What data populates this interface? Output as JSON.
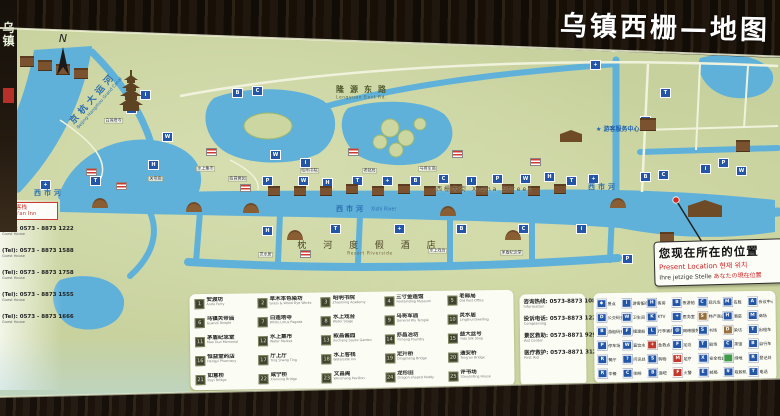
{
  "title": "乌镇西栅—地图",
  "compass": "N",
  "left_sign": "乌镇",
  "map": {
    "canal": {
      "zh": "京杭大运河",
      "en": "Beijing-Hangzhou Grand Canal"
    },
    "xishi_river": {
      "zh": "西市河",
      "en": "Xishi River"
    },
    "xizha_street": {
      "zh": "西栅大街",
      "en": "Xizha Street"
    },
    "north_road": {
      "zh": "隆源东路",
      "en": "Longyuan East Rd."
    },
    "resort": {
      "zh": "枕 河 度 假 酒 店",
      "en": "Resort Riverside"
    },
    "visitor_center": {
      "zh": "★ 游客服务中心",
      "en": "Visitor Service Center"
    },
    "present": {
      "zh": "您现在所在的位置",
      "en": "Present Location",
      "ko": "현재 위치",
      "de": "Ihre jetzige Stelle",
      "ja": "あなたの現在位置"
    },
    "venue_box": {
      "zh": "通安客栈",
      "en": "Tong'an Inn"
    },
    "phones": [
      {
        "num": "(Tel): 0573 - 8873 1222",
        "sub": "Guest House"
      },
      {
        "num": "(Tel): 0573 - 8873 1588",
        "sub": "Guest House"
      },
      {
        "num": "(Tel): 0573 - 8873 1758",
        "sub": "Guest House"
      },
      {
        "num": "(Tel): 0573 - 8873 1555",
        "sub": "Guest House"
      },
      {
        "num": "(Tel): 0573 - 8873 1666",
        "sub": "Guest House"
      }
    ],
    "markers": {
      "glyphs": [
        "i",
        "P",
        "W",
        "H",
        "T",
        "+",
        "B",
        "C"
      ],
      "blue": [
        [
          140,
          90
        ],
        [
          126,
          104
        ],
        [
          162,
          132
        ],
        [
          148,
          160
        ],
        [
          90,
          176
        ],
        [
          40,
          180
        ],
        [
          232,
          88
        ],
        [
          252,
          86
        ],
        [
          300,
          158
        ],
        [
          262,
          176
        ],
        [
          298,
          176
        ],
        [
          322,
          178
        ],
        [
          352,
          176
        ],
        [
          382,
          176
        ],
        [
          410,
          176
        ],
        [
          438,
          174
        ],
        [
          466,
          176
        ],
        [
          492,
          174
        ],
        [
          520,
          174
        ],
        [
          544,
          172
        ],
        [
          566,
          176
        ],
        [
          588,
          174
        ],
        [
          640,
          172
        ],
        [
          658,
          170
        ],
        [
          700,
          164
        ],
        [
          718,
          158
        ],
        [
          736,
          166
        ],
        [
          262,
          226
        ],
        [
          330,
          224
        ],
        [
          394,
          224
        ],
        [
          456,
          224
        ],
        [
          518,
          224
        ],
        [
          576,
          224
        ],
        [
          622,
          254
        ],
        [
          270,
          150
        ],
        [
          640,
          116
        ],
        [
          660,
          88
        ],
        [
          590,
          60
        ],
        [
          612,
          42
        ]
      ],
      "flags": [
        [
          86,
          168
        ],
        [
          116,
          182
        ],
        [
          206,
          148
        ],
        [
          240,
          184
        ],
        [
          348,
          148
        ],
        [
          452,
          150
        ],
        [
          530,
          158
        ],
        [
          300,
          250
        ]
      ],
      "buildings": [
        [
          268,
          186,
          12,
          7
        ],
        [
          294,
          186,
          12,
          7
        ],
        [
          320,
          186,
          12,
          7
        ],
        [
          346,
          184,
          12,
          7
        ],
        [
          372,
          186,
          12,
          7
        ],
        [
          398,
          184,
          12,
          7
        ],
        [
          424,
          186,
          12,
          7
        ],
        [
          450,
          184,
          12,
          7
        ],
        [
          476,
          186,
          12,
          7
        ],
        [
          502,
          184,
          12,
          7
        ],
        [
          528,
          186,
          12,
          7
        ],
        [
          554,
          184,
          12,
          7
        ],
        [
          20,
          56,
          14,
          8
        ],
        [
          38,
          60,
          14,
          8
        ],
        [
          56,
          64,
          14,
          8
        ],
        [
          74,
          68,
          14,
          8
        ],
        [
          640,
          118,
          16,
          10
        ],
        [
          660,
          232,
          14,
          9
        ],
        [
          330,
          22,
          14,
          9
        ],
        [
          736,
          140,
          14,
          9
        ]
      ],
      "temples": [
        [
          688,
          200,
          34,
          17
        ],
        [
          560,
          130,
          22,
          12
        ]
      ],
      "bridges": [
        [
          92,
          198
        ],
        [
          186,
          202
        ],
        [
          243,
          203
        ],
        [
          440,
          206
        ],
        [
          610,
          198
        ],
        [
          287,
          230
        ],
        [
          505,
          230
        ]
      ],
      "tags": [
        {
          "zh": "白莲塔寺",
          "x": 104,
          "y": 118
        },
        {
          "zh": "水上集市",
          "x": 196,
          "y": 166
        },
        {
          "zh": "昭明书院",
          "x": 300,
          "y": 168
        },
        {
          "zh": "老邮局",
          "x": 362,
          "y": 168
        },
        {
          "zh": "乌将军庙",
          "x": 418,
          "y": 166
        },
        {
          "zh": "灵水居",
          "x": 258,
          "y": 252
        },
        {
          "zh": "水上戏台",
          "x": 428,
          "y": 248
        },
        {
          "zh": "茅盾纪念堂",
          "x": 500,
          "y": 250
        },
        {
          "zh": "关帝庙",
          "x": 148,
          "y": 176
        },
        {
          "zh": "叙昌酱园",
          "x": 228,
          "y": 176
        }
      ]
    }
  },
  "legend": {
    "attractions": [
      {
        "zh": "安渡坊",
        "en": "Andu Ferry"
      },
      {
        "zh": "草木本色染坊",
        "en": "Grass & Wood Dye Works"
      },
      {
        "zh": "昭明书院",
        "en": "Zhaoming Academy"
      },
      {
        "zh": "三寸金莲馆",
        "en": "Footbinding Museum"
      },
      {
        "zh": "老邮局",
        "en": "Old Post Office"
      },
      {
        "zh": "乌镇关帝庙",
        "en": "Guandi Temple"
      },
      {
        "zh": "白莲塔寺",
        "en": "White Lotus Pagoda"
      },
      {
        "zh": "水上戏台",
        "en": "Water Stage"
      },
      {
        "zh": "乌将军庙",
        "en": "General Wu Temple"
      },
      {
        "zh": "灵水居",
        "en": "Lingshui Dwelling"
      },
      {
        "zh": "茅盾纪念堂",
        "en": "Mao Dun Memorial"
      },
      {
        "zh": "水上集市",
        "en": "Water Market"
      },
      {
        "zh": "叙昌酱园",
        "en": "Xuchang Sauce Garden"
      },
      {
        "zh": "亦昌冶坊",
        "en": "Yichang Foundry"
      },
      {
        "zh": "益大丝号",
        "en": "Yida Silk Shop"
      },
      {
        "zh": "恒益堂药店",
        "en": "Hengyi Pharmacy"
      },
      {
        "zh": "厅上厅",
        "en": "Ting Shang Ting"
      },
      {
        "zh": "水上客栈",
        "en": "Waterside Inn"
      },
      {
        "zh": "定升桥",
        "en": "Dingsheng Bridge"
      },
      {
        "zh": "通安桥",
        "en": "Tong'an Bridge"
      },
      {
        "zh": "如意桥",
        "en": "Ruyi Bridge"
      },
      {
        "zh": "咸宁桥",
        "en": "Xianning Bridge"
      },
      {
        "zh": "文昌阁",
        "en": "Wenchang Pavilion"
      },
      {
        "zh": "龙形田",
        "en": "Dragon-shaped Paddy"
      },
      {
        "zh": "评书场",
        "en": "Storytelling House"
      }
    ],
    "hotlines": [
      {
        "zh": "咨询热线: 0573-8873 1088",
        "en": "Information"
      },
      {
        "zh": "投诉电话: 0573-8873 1224",
        "en": "Complaining"
      },
      {
        "zh": "景区救助: 0573-8871 9299",
        "en": "Aid Center"
      },
      {
        "zh": "医疗救护: 0573-8871 3120",
        "en": "First Aid"
      }
    ],
    "services": [
      {
        "zh": "景点",
        "g": "◆",
        "c": "#2456a8"
      },
      {
        "zh": "游客服务",
        "g": "i",
        "c": "#2456a8"
      },
      {
        "zh": "客房",
        "g": "H",
        "c": "#2456a8"
      },
      {
        "zh": "夜游船",
        "g": "B",
        "c": "#2456a8"
      },
      {
        "zh": "观光车",
        "g": "C",
        "c": "#2456a8"
      },
      {
        "zh": "名胜",
        "g": "M",
        "c": "#2456a8"
      },
      {
        "zh": "会议中心",
        "g": "A",
        "c": "#2456a8"
      },
      {
        "zh": "公交码头",
        "g": "D",
        "c": "#2456a8"
      },
      {
        "zh": "卫生间",
        "g": "W",
        "c": "#2456a8"
      },
      {
        "zh": "KTV",
        "g": "K",
        "c": "#2456a8"
      },
      {
        "zh": "医务室",
        "g": "+",
        "c": "#2456a8"
      },
      {
        "zh": "特产商店",
        "g": "S",
        "c": "#96713d"
      },
      {
        "zh": "酒店",
        "g": "H",
        "c": "#2456a8"
      },
      {
        "zh": "商场",
        "g": "M",
        "c": "#2456a8"
      },
      {
        "zh": "游船码头",
        "g": "B",
        "c": "#2456a8"
      },
      {
        "zh": "摆渡船",
        "g": "F",
        "c": "#2456a8"
      },
      {
        "zh": "行李寄存",
        "g": "L",
        "c": "#2456a8"
      },
      {
        "zh": "网络服务",
        "g": "@",
        "c": "#2456a8"
      },
      {
        "zh": "书场",
        "g": "S",
        "c": "#2456a8"
      },
      {
        "zh": "染坊",
        "g": "D",
        "c": "#96713d"
      },
      {
        "zh": "出租车",
        "g": "T",
        "c": "#2456a8"
      },
      {
        "zh": "停车场",
        "g": "P",
        "c": "#2456a8"
      },
      {
        "zh": "直饮水",
        "g": "W",
        "c": "#2456a8"
      },
      {
        "zh": "急救点",
        "g": "+",
        "c": "#c0392b"
      },
      {
        "zh": "足浴",
        "g": "F",
        "c": "#2456a8"
      },
      {
        "zh": "剧场",
        "g": "T",
        "c": "#2456a8"
      },
      {
        "zh": "茶馆",
        "g": "C",
        "c": "#2456a8"
      },
      {
        "zh": "自行车",
        "g": "B",
        "c": "#2456a8"
      },
      {
        "zh": "餐厅",
        "g": "R",
        "c": "#2456a8"
      },
      {
        "zh": "问讯处",
        "g": "?",
        "c": "#2456a8"
      },
      {
        "zh": "购物",
        "g": "S",
        "c": "#2456a8"
      },
      {
        "zh": "足疗",
        "g": "M",
        "c": "#c0392b"
      },
      {
        "zh": "安全检查",
        "g": "X",
        "c": "#2456a8"
      },
      {
        "zh": "绿地",
        "g": "",
        "c": "#3f9b4a"
      },
      {
        "zh": "登记处",
        "g": "R",
        "c": "#2456a8"
      },
      {
        "zh": "中餐",
        "g": "R",
        "c": "#2456a8"
      },
      {
        "zh": "咖啡",
        "g": "C",
        "c": "#2456a8"
      },
      {
        "zh": "酒吧",
        "g": "B",
        "c": "#2456a8"
      },
      {
        "zh": "火警",
        "g": "F",
        "c": "#c0392b"
      },
      {
        "zh": "邮局",
        "g": "E",
        "c": "#2456a8"
      },
      {
        "zh": "取款机",
        "g": "¥",
        "c": "#2456a8"
      },
      {
        "zh": "电话",
        "g": "T",
        "c": "#2456a8"
      }
    ]
  }
}
